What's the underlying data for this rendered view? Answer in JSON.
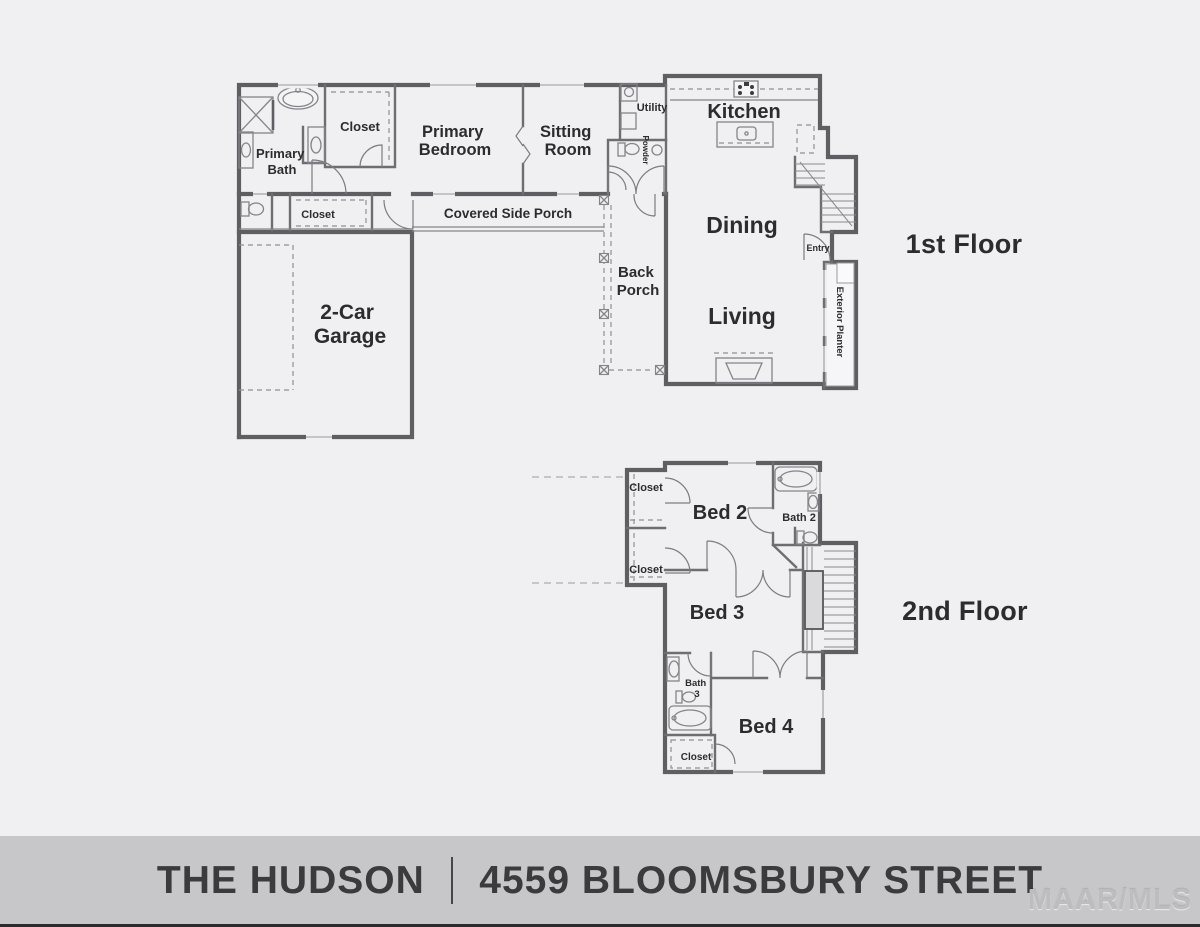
{
  "colors": {
    "background": "#f0f0f2",
    "banner": "#c7c7ca",
    "wall": "#5e5e63",
    "label_text": "#2c2c2e",
    "banner_text": "#3b3b3d",
    "watermark": "#bdbdc1",
    "footer_strip": "#2b2b2d"
  },
  "floor1": {
    "title": "1st Floor",
    "rooms": {
      "primary_bath": [
        "Primary",
        "Bath"
      ],
      "closet": "Closet",
      "primary_bedroom": [
        "Primary",
        "Bedroom"
      ],
      "sitting_room": [
        "Sitting",
        "Room"
      ],
      "utility": "Utility",
      "powder": "Powder",
      "kitchen": "Kitchen",
      "dining": "Dining",
      "living": "Living",
      "entry": "Entry",
      "exterior_planter": "Exterior Planter",
      "covered_side_porch": "Covered Side Porch",
      "hall_closet": "Closet",
      "back_porch": [
        "Back",
        "Porch"
      ],
      "garage": [
        "2-Car",
        "Garage"
      ]
    }
  },
  "floor2": {
    "title": "2nd Floor",
    "rooms": {
      "closet_top": "Closet",
      "closet_mid": "Closet",
      "bed2": "Bed 2",
      "bath2": "Bath 2",
      "bed3": "Bed 3",
      "bath3": [
        "Bath",
        "3"
      ],
      "bed4": "Bed 4",
      "closet_bottom": "Closet"
    }
  },
  "footer": {
    "plan_name": "THE HUDSON",
    "address": "4559 BLOOMSBURY STREET",
    "watermark": "MAAR/MLS"
  }
}
